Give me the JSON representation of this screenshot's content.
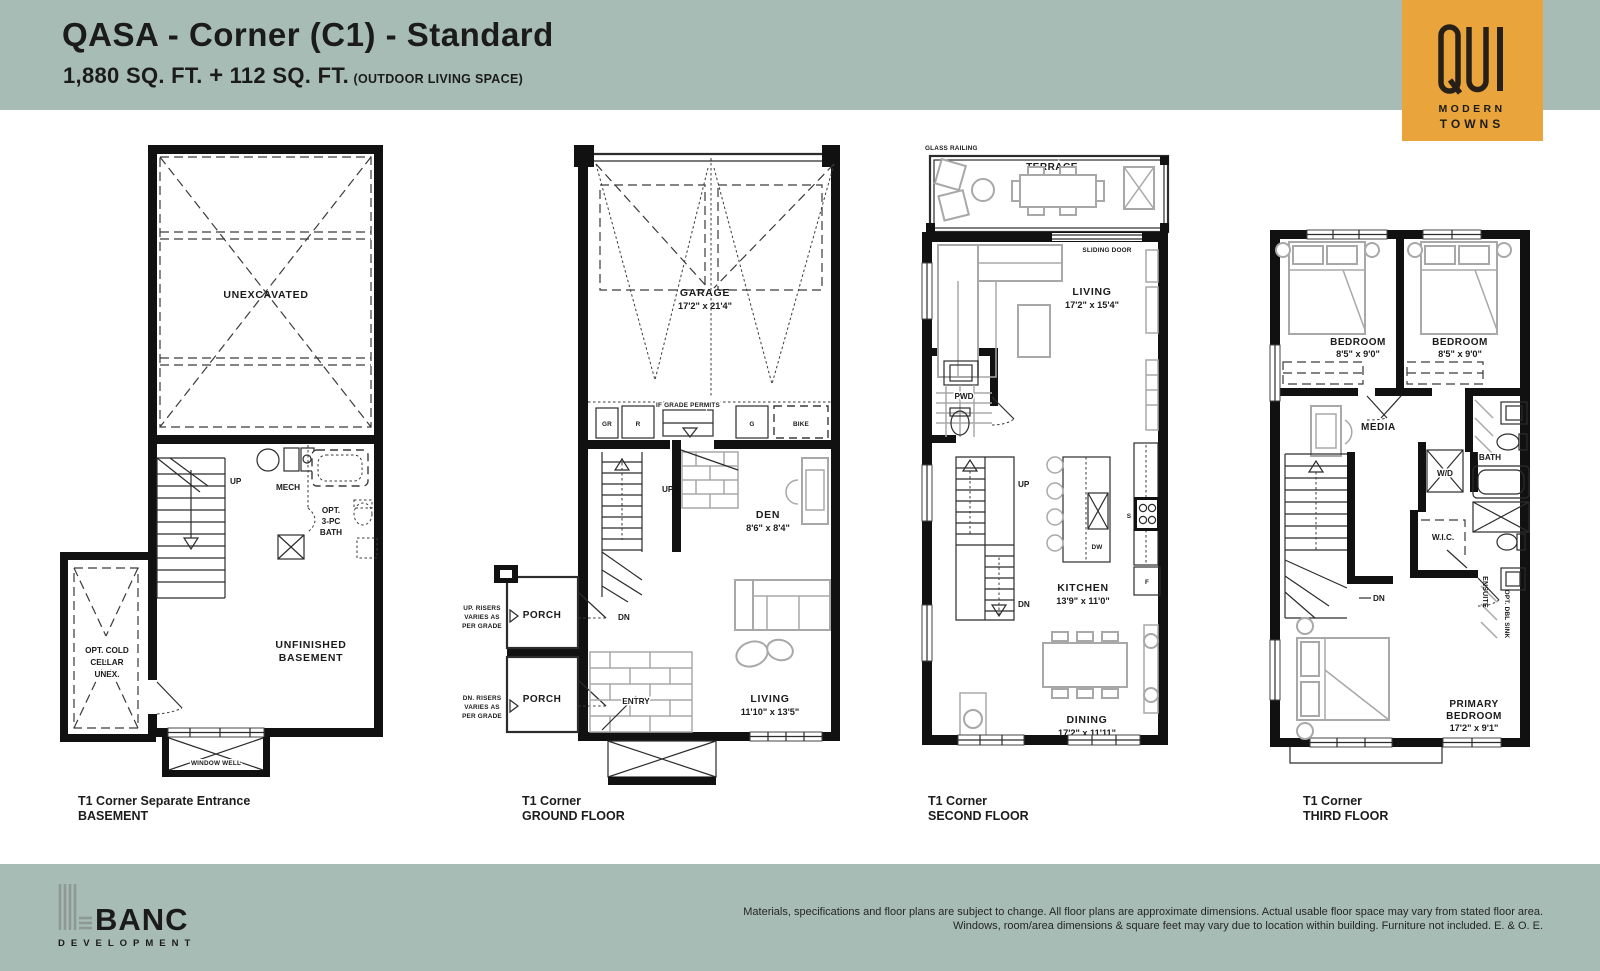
{
  "header": {
    "title": "QASA - Corner (C1) - Standard",
    "area": "1,880 SQ. FT.",
    "plus": "+",
    "area2": "112 SQ. FT.",
    "outdoor": "(OUTDOOR LIVING SPACE)"
  },
  "logo": {
    "word": "QUI",
    "sub1": "MODERN",
    "sub2": "TOWNS",
    "bg": "#E9A43C"
  },
  "plans": {
    "b": {
      "unexcavated": "UNEXCAVATED",
      "up": "UP",
      "mech": "MECH",
      "bath1": "OPT.",
      "bath2": "3-PC",
      "bath3": "BATH",
      "cold1": "OPT. COLD",
      "cold2": "CELLAR",
      "cold3": "UNEX.",
      "unf1": "UNFINISHED",
      "unf2": "BASEMENT",
      "well": "WINDOW WELL",
      "cap1": "T1 Corner Separate Entrance",
      "cap2": "BASEMENT"
    },
    "g": {
      "garage": "GARAGE",
      "garage_d": "17'2\" x 21'4\"",
      "grade": "IF GRADE PERMITS",
      "gr": "GR",
      "r": "R",
      "gg": "G",
      "bike": "BIKE",
      "up": "UP",
      "dn": "DN",
      "den": "DEN",
      "den_d": "8'6\" x 8'4\"",
      "porch1": "PORCH",
      "porch2": "PORCH",
      "upr1": "UP. RISERS",
      "upr2": "VARIES AS",
      "upr3": "PER GRADE",
      "dnr1": "DN. RISERS",
      "dnr2": "VARIES AS",
      "dnr3": "PER GRADE",
      "entry": "ENTRY",
      "living": "LIVING",
      "living_d": "11'10\" x 13'5\"",
      "cap1": "T1 Corner",
      "cap2": "GROUND FLOOR"
    },
    "s": {
      "glass": "GLASS RAILING",
      "terrace": "TERRACE",
      "sliding": "SLIDING DOOR",
      "living": "LIVING",
      "living_d": "17'2\" x 15'4\"",
      "pwd": "PWD",
      "up": "UP",
      "dn": "DN",
      "kitchen": "KITCHEN",
      "kitchen_d": "13'9\" x 11'0\"",
      "dw": "DW",
      "sink": "S",
      "fridge": "F",
      "dining": "DINING",
      "dining_d": "17'2\" x 11'11\"",
      "cap1": "T1 Corner",
      "cap2": "SECOND FLOOR"
    },
    "t": {
      "bed1": "BEDROOM",
      "bed1_d": "8'5\" x 9'0\"",
      "bed2": "BEDROOM",
      "bed2_d": "8'5\" x 9'0\"",
      "media": "MEDIA",
      "bath": "BATH",
      "wd": "W/D",
      "wic": "W.I.C.",
      "dn": "DN",
      "ensuite": "ENSUITE",
      "dbl": "OPT. DBL SINK",
      "pri1": "PRIMARY",
      "pri2": "BEDROOM",
      "pri3": "17'2\" x 9'1\"",
      "cap1": "T1 Corner",
      "cap2": "THIRD FLOOR"
    }
  },
  "footer": {
    "brand": "BANC",
    "brand_sub": "DEVELOPMENT",
    "disc1": "Materials, specifications and floor plans are subject to change. All floor plans are approximate dimensions. Actual usable floor space may vary from stated floor area.",
    "disc2": "Windows, room/area dimensions & square feet may vary due to location within building. Furniture not included. E. & O. E."
  }
}
